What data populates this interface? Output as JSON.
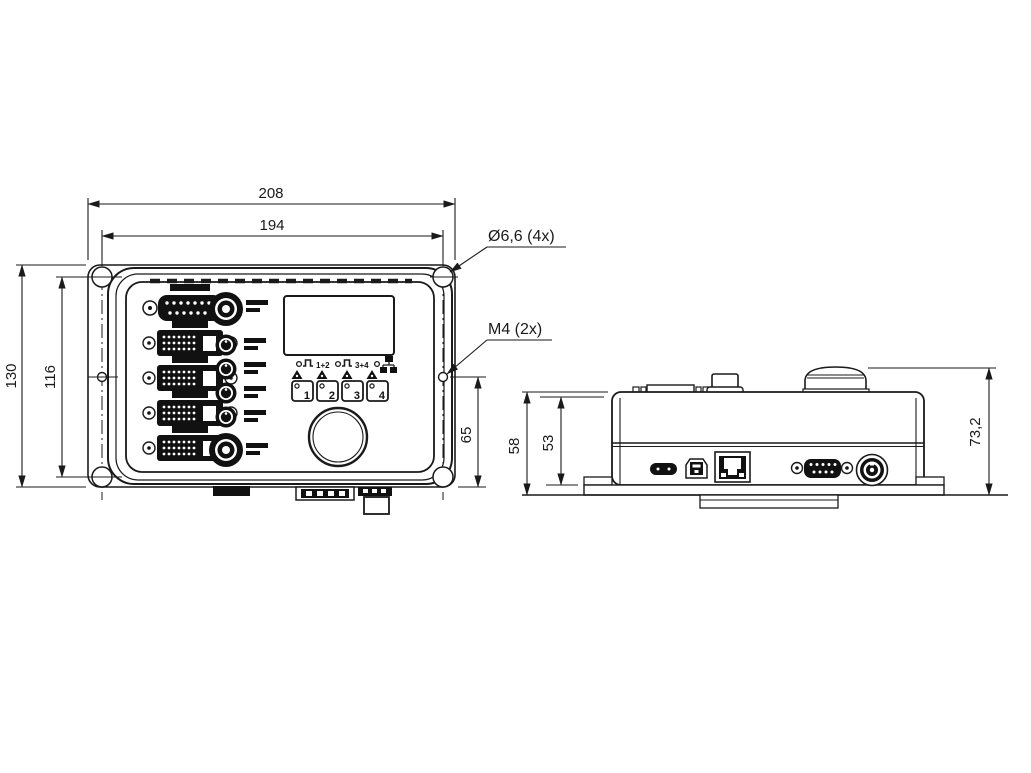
{
  "front_view": {
    "dim_overall_width": "208",
    "dim_hole_spacing_width": "194",
    "dim_overall_height": "130",
    "dim_hole_spacing_height": "116",
    "dim_m4_to_base": "65",
    "callout_corner_holes": "Ø6,6 (4x)",
    "callout_side_threads": "M4 (2x)",
    "indicators": {
      "group1": "1+2",
      "group2": "3+4"
    },
    "buttons": [
      "1",
      "2",
      "3",
      "4"
    ]
  },
  "side_view": {
    "dim_body_height": "58",
    "dim_inner_height": "53",
    "dim_total_height": "73,2"
  },
  "colors": {
    "line": "#1a1a1a",
    "background": "#ffffff"
  }
}
